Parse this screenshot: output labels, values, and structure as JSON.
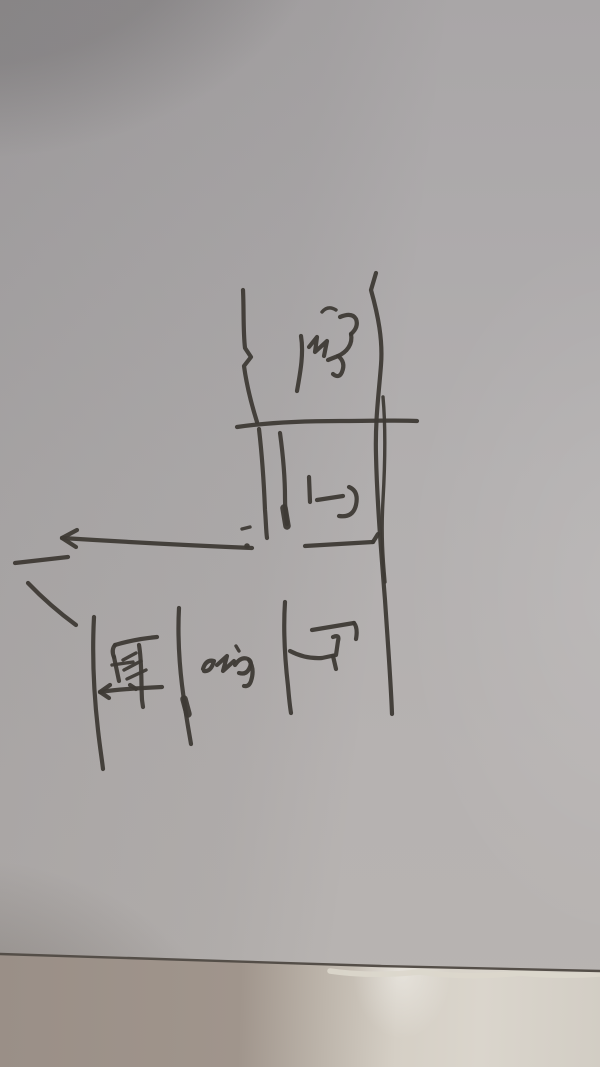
{
  "scene": {
    "description": "Photograph of a rough hand-drawn apartment floor plan sketched in black marker on gray paper, with a soft camera shadow at the top left and the paper's bottom edge resting on a lighter table surface",
    "medium": "black marker on paper",
    "paper_color": "#b2afaf",
    "ink_color": "#3e3a35",
    "table_surface_color": "#d5cfc5",
    "paper_edge_color": "#544e48"
  },
  "labels": {
    "balcony": "阳",
    "bathroom": "卫",
    "kitchen": "厨",
    "room": "室",
    "hall": "厅"
  }
}
